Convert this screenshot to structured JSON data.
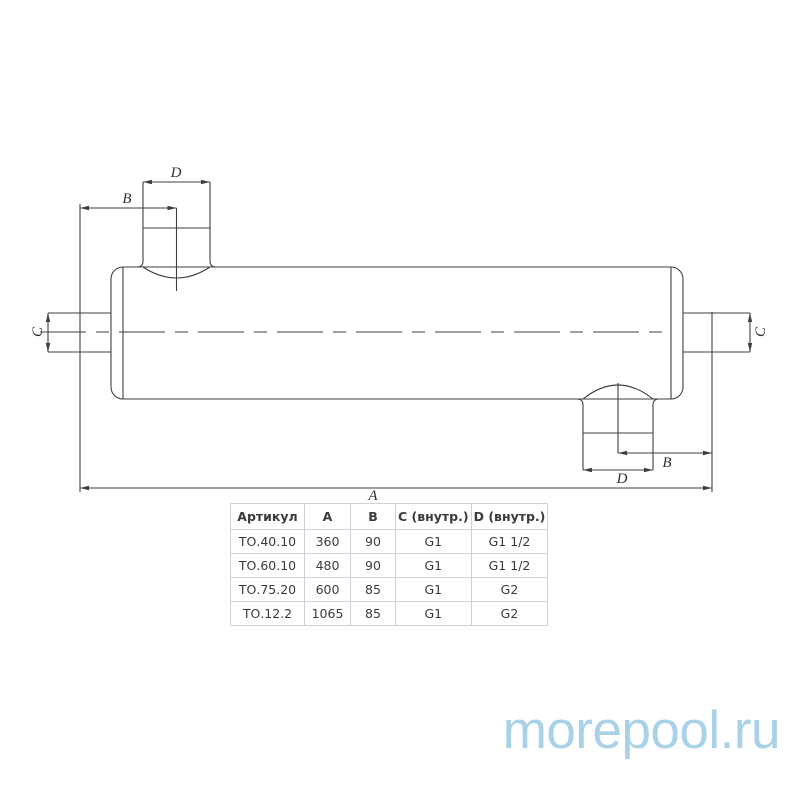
{
  "drawing": {
    "labels": {
      "a": "A",
      "b": "B",
      "c": "C",
      "d": "D"
    },
    "line_color": "#3f3f3f"
  },
  "table": {
    "headers": [
      "Артикул",
      "A",
      "B",
      "C (внутр.)",
      "D (внутр.)"
    ],
    "rows": [
      [
        "ТО.40.10",
        "360",
        "90",
        "G1",
        "G1 1/2"
      ],
      [
        "ТО.60.10",
        "480",
        "90",
        "G1",
        "G1 1/2"
      ],
      [
        "ТО.75.20",
        "600",
        "85",
        "G1",
        "G2"
      ],
      [
        "ТО.12.2",
        "1065",
        "85",
        "G1",
        "G2"
      ]
    ],
    "border_color": "#cbd2da",
    "text_color": "#3b3b3b"
  },
  "watermark": {
    "text": "morepool.ru",
    "color": "#a9d1e8"
  }
}
